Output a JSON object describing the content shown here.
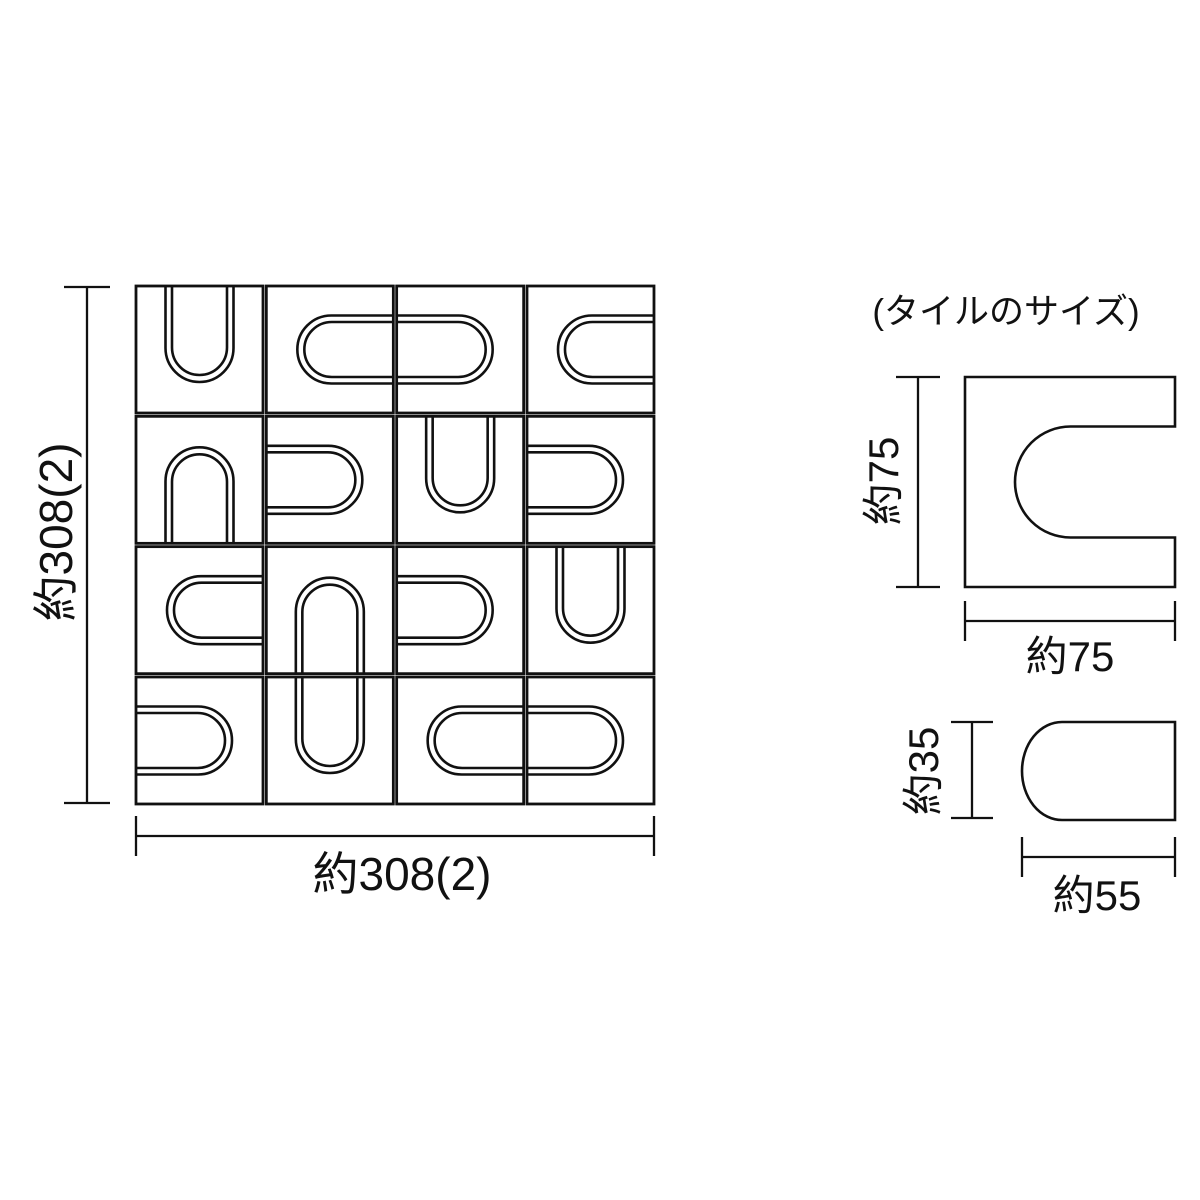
{
  "page": {
    "background_color": "#ffffff",
    "line_color": "#111111",
    "description": "Dimension drawing of a mosaic tile sheet with U-notched square tiles and dome insert pieces"
  },
  "labels": {
    "grid_height": "約308(2)",
    "grid_width": "約308(2)",
    "detail_header": "(タイルのサイズ)",
    "tile_height": "約75",
    "tile_width": "約75",
    "piece_height": "約35",
    "piece_width": "約55"
  },
  "sheet": {
    "rows": 4,
    "cols": 4,
    "size_label_mm": "308",
    "joint_label_mm": "2",
    "tile_label_mm": "75",
    "piece_height_label_mm": "35",
    "piece_width_label_mm": "55",
    "u_orientations": [
      [
        "up",
        "right",
        "left",
        "right"
      ],
      [
        "down",
        "left",
        "up",
        "left"
      ],
      [
        "right",
        "down",
        "left",
        "up"
      ],
      [
        "left",
        "up",
        "right",
        "left"
      ]
    ]
  },
  "drawing": {
    "grid": {
      "x": 136,
      "y": 286,
      "tile_px": 127,
      "gap_px": 3.33,
      "border_stroke": 2.8,
      "u_stroke": 2.6,
      "u_outer": {
        "half_width": 34,
        "depth": 96,
        "radius": 34
      },
      "u_inner": {
        "half_width": 27.5,
        "depth": 89,
        "radius": 27.5
      }
    },
    "detail": {
      "square": {
        "x": 965,
        "y": 377,
        "size": 210,
        "notch_across": 111,
        "notch_depth": 160,
        "stroke": 2.6
      },
      "piece": {
        "x": 1022,
        "y": 722,
        "w": 153,
        "h": 98,
        "rx": 40,
        "stroke": 2.6
      }
    },
    "dim_stroke": 2.3,
    "dim_segments": [
      {
        "x1": 87,
        "y1": 287,
        "x2": 87,
        "y2": 803
      },
      {
        "x1": 64,
        "y1": 287,
        "x2": 110,
        "y2": 287
      },
      {
        "x1": 64,
        "y1": 803,
        "x2": 110,
        "y2": 803
      },
      {
        "x1": 136,
        "y1": 836,
        "x2": 654,
        "y2": 836
      },
      {
        "x1": 136,
        "y1": 816,
        "x2": 136,
        "y2": 856
      },
      {
        "x1": 654,
        "y1": 816,
        "x2": 654,
        "y2": 856
      },
      {
        "x1": 918,
        "y1": 377,
        "x2": 918,
        "y2": 587
      },
      {
        "x1": 896,
        "y1": 377,
        "x2": 940,
        "y2": 377
      },
      {
        "x1": 896,
        "y1": 587,
        "x2": 940,
        "y2": 587
      },
      {
        "x1": 965,
        "y1": 621,
        "x2": 1175,
        "y2": 621
      },
      {
        "x1": 965,
        "y1": 601,
        "x2": 965,
        "y2": 641
      },
      {
        "x1": 1175,
        "y1": 601,
        "x2": 1175,
        "y2": 641
      },
      {
        "x1": 972,
        "y1": 722,
        "x2": 972,
        "y2": 818
      },
      {
        "x1": 951,
        "y1": 722,
        "x2": 993,
        "y2": 722
      },
      {
        "x1": 951,
        "y1": 818,
        "x2": 993,
        "y2": 818
      },
      {
        "x1": 1022,
        "y1": 857,
        "x2": 1175,
        "y2": 857
      },
      {
        "x1": 1022,
        "y1": 837,
        "x2": 1022,
        "y2": 877
      },
      {
        "x1": 1175,
        "y1": 837,
        "x2": 1175,
        "y2": 877
      }
    ]
  }
}
